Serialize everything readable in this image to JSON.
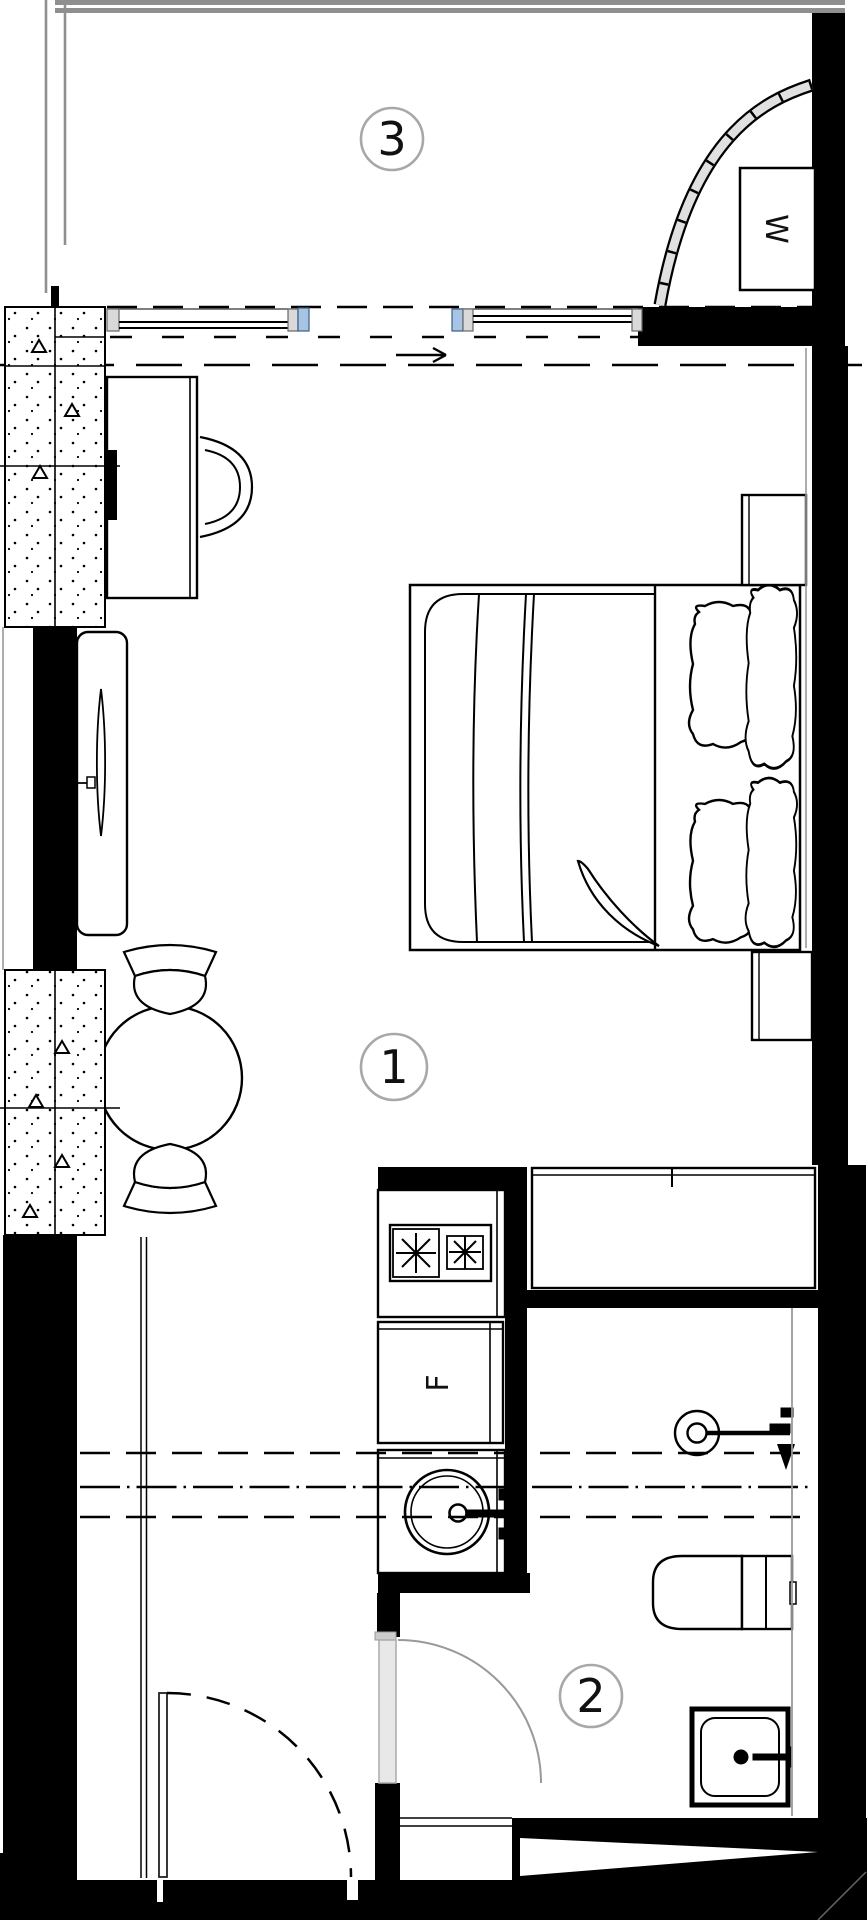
{
  "title": "Studio apartment floor plan",
  "rooms": [
    {
      "number": "3",
      "name": "balcony"
    },
    {
      "number": "1",
      "name": "main-room"
    },
    {
      "number": "2",
      "name": "bathroom"
    }
  ],
  "appliances": {
    "washer_label": "W",
    "fridge_label": "F"
  },
  "colors": {
    "wall": "#000000",
    "glass": "#a7c4e4",
    "label_stroke": "#a8a8a8",
    "door_leaf": "#e8e8e8",
    "balcony_edge": "#8f8f8f"
  }
}
